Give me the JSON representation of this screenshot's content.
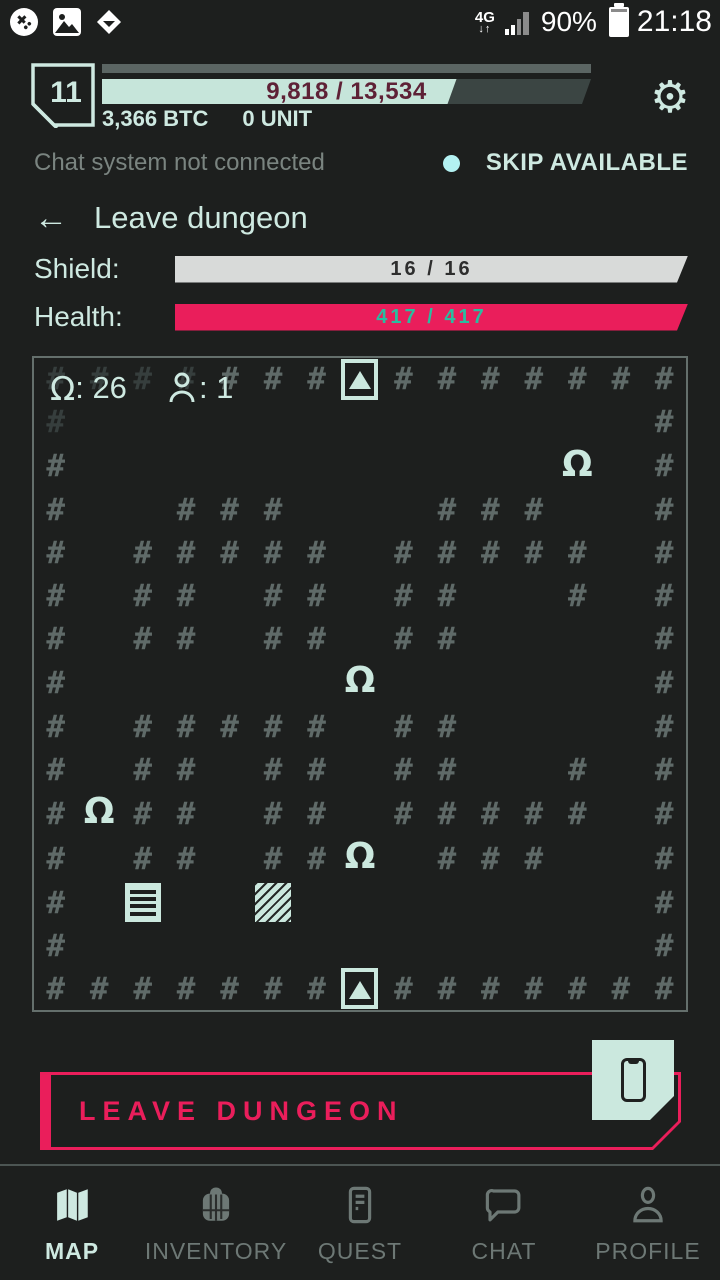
{
  "status_bar": {
    "time": "21:18",
    "battery_percent": "90%",
    "network_type": "4G",
    "network_arrows": "↓↑"
  },
  "header": {
    "level": "11",
    "xp_text": "9,818 / 13,534",
    "xp_percent": 72.5,
    "btc": "3,366 BTC",
    "unit": "0 UNIT"
  },
  "notice": {
    "chat_status": "Chat system not connected",
    "skip_label": "SKIP AVAILABLE"
  },
  "back": {
    "arrow": "←",
    "label": "Leave dungeon"
  },
  "stats": {
    "shield_label": "Shield:",
    "shield_value": "16 / 16",
    "health_label": "Health:",
    "health_value": "417 / 417"
  },
  "map": {
    "legend": {
      "monster_glyph": "Ω",
      "monster_count": ": 26",
      "player_count": ": 1"
    },
    "glyphs": {
      "wall": "#",
      "monster": "Ω"
    },
    "grid": [
      "dddd###S#######",
      "d.............#",
      "#...........M.#",
      "#..###...###..#",
      "#.#####.#####.#",
      "#.##.##.##..#.#",
      "#.##.##.##....#",
      "#......M......#",
      "#.#####.##....#",
      "#.##.##.##..#.#",
      "#M##.##.#####.#",
      "#.##.##M.###..#",
      "#.L..H........#",
      "#.............#",
      "#######S#######"
    ]
  },
  "action": {
    "leave_label": "LEAVE DUNGEON"
  },
  "nav": {
    "items": [
      {
        "label": "MAP",
        "active": true
      },
      {
        "label": "INVENTORY",
        "active": false
      },
      {
        "label": "QUEST",
        "active": false
      },
      {
        "label": "CHAT",
        "active": false
      },
      {
        "label": "PROFILE",
        "active": false
      }
    ]
  },
  "colors": {
    "background": "#1d1f1e",
    "mint": "#cee9e1",
    "pink": "#ea1e5b",
    "teal": "#2abda0",
    "wall_gray": "#5f6a68",
    "xp_text_maroon": "#5e2136",
    "skip_dot_cyan": "#b3f1f2"
  }
}
